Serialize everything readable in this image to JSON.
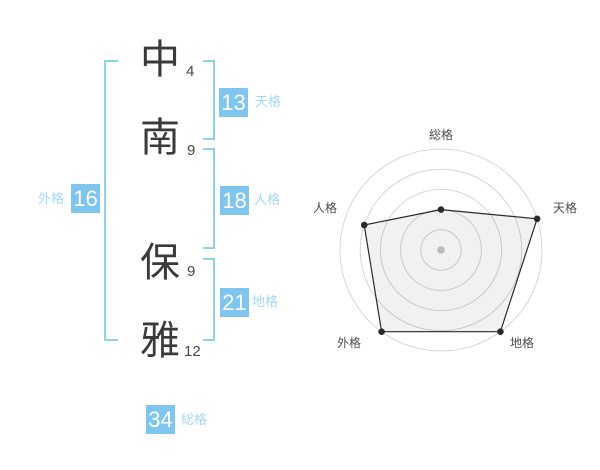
{
  "name_panel": {
    "family_name": [
      {
        "char": "中",
        "strokes": "4"
      },
      {
        "char": "南",
        "strokes": "9"
      }
    ],
    "given_name": [
      {
        "char": "保",
        "strokes": "9"
      },
      {
        "char": "雅",
        "strokes": "12"
      }
    ],
    "kaku": {
      "tenkaku": {
        "label": "天格",
        "value": "13"
      },
      "jinkaku": {
        "label": "人格",
        "value": "18"
      },
      "chikaku": {
        "label": "地格",
        "value": "21"
      },
      "gaikaku": {
        "label": "外格",
        "value": "16"
      },
      "soukaku": {
        "label": "総格",
        "value": "34"
      }
    }
  },
  "colors": {
    "accent_blue": "#7ec6ef",
    "bracket_blue": "#8ed1f3",
    "label_blue": "#a6d8f5",
    "text_dark": "#3a3a3a",
    "grid_gray": "#d5d5d5",
    "polygon_stroke": "#2a2a2a",
    "center_dot": "#bcbcbc"
  },
  "chart_data": {
    "type": "radar",
    "axes": [
      "総格",
      "天格",
      "地格",
      "外格",
      "人格"
    ],
    "values": [
      2,
      5,
      5,
      5,
      4
    ],
    "max": 5,
    "rings": 5,
    "grid": "concentric-circles",
    "legend": "none",
    "associated_numbers": {
      "総格": 34,
      "天格": 13,
      "地格": 21,
      "外格": 16,
      "人格": 18
    }
  }
}
